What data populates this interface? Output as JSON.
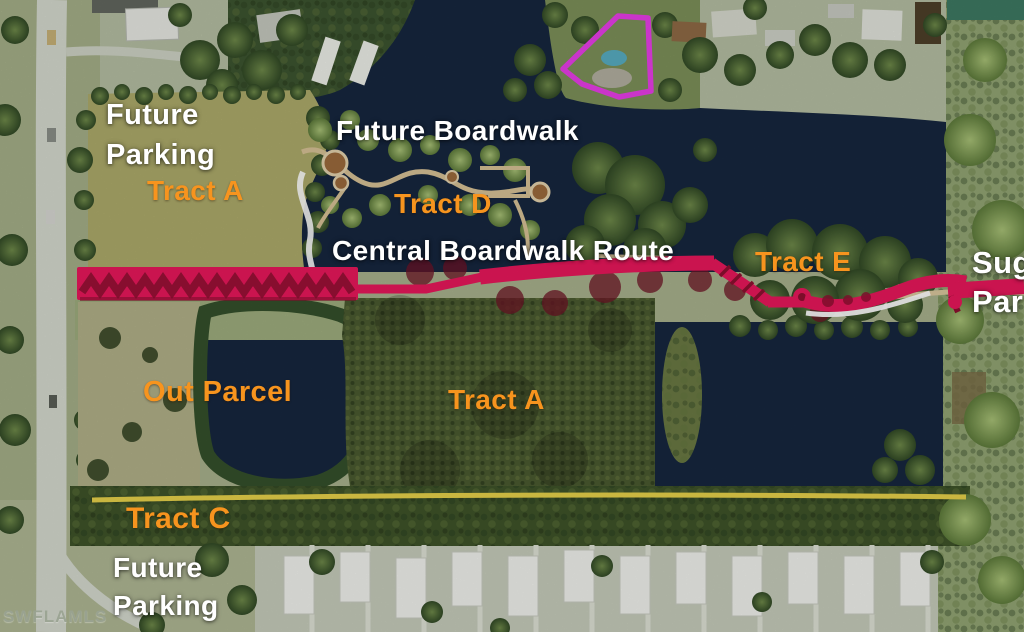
{
  "map": {
    "labels": {
      "future_parking_top_line1": "Future",
      "future_parking_top_line2": "Parking",
      "tract_a_top": "Tract A",
      "future_boardwalk": "Future Boardwalk",
      "tract_d": "Tract D",
      "central_boardwalk_route": "Central Boardwalk Route",
      "tract_e": "Tract E",
      "edge_clipped_line1": "Sug",
      "edge_clipped_line2": "Par",
      "out_parcel": "Out Parcel",
      "tract_a_center": "Tract A",
      "tract_c": "Tract C",
      "future_parking_bottom_line1": "Future",
      "future_parking_bottom_line2": "Parking"
    },
    "watermark": "SWFLAMLS",
    "colors": {
      "tract_label_orange": "#f7941e",
      "label_white": "#ffffff",
      "route_pink": "#e9185c",
      "route_dark_red": "#8e1030",
      "boundary_yellow": "#e8d24a",
      "parcel_outline_magenta": "#e93ee9",
      "water_navy": "#16273f",
      "forest_dark_green": "#3f5429",
      "parking_olive": "#aeab6b",
      "road_gray": "#d6dacf",
      "watermark_gray": "#9aa392"
    },
    "overlays": [
      {
        "name": "central-boardwalk-route-line",
        "color_ref": "route_pink"
      },
      {
        "name": "tract-c-boundary-line",
        "color_ref": "boundary_yellow"
      },
      {
        "name": "highlighted-parcel-outline",
        "color_ref": "parcel_outline_magenta"
      }
    ]
  }
}
